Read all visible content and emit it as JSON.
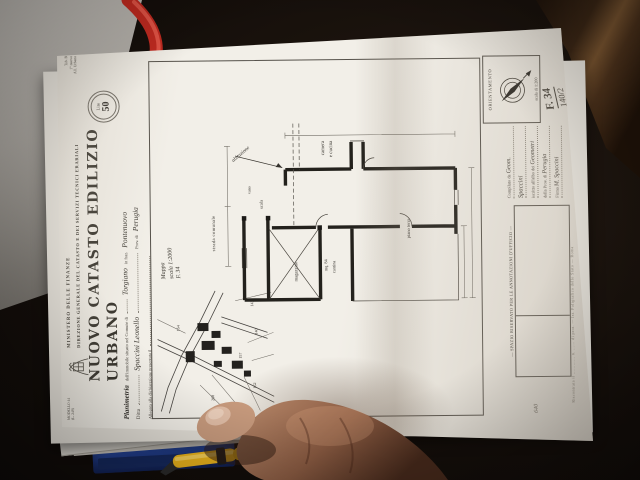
{
  "colors": {
    "paper": "#f2efe8",
    "folder_blue": "#2b51b0",
    "pen_yellow": "#e8b117",
    "tool_red": "#bf2a20",
    "ink": "#2e2b26"
  },
  "document": {
    "corner_top_left": [
      "MODELLO 44",
      "(L. 249)"
    ],
    "corner_top_right": [
      "Tab. B",
      "1° nuovo",
      "All. Urbano"
    ],
    "stamp": {
      "currency": "Lire",
      "value": "50"
    },
    "ministry": [
      "MINISTERO DELLE FINANZE",
      "DIREZIONE GENERALE DEL CATASTO E DEI SERVIZI TECNICI ERARIALI"
    ],
    "title": "NUOVO CATASTO EDILIZIO URBANO",
    "fields": {
      "f1_label": "Planimetria",
      "f1_pre": "dell'immobile situato nel Comune di",
      "f1_value": "Torgiano",
      "f1_mid": "in fraz.",
      "f1_value2": "Pontenuovo",
      "f2_label": "Ditta",
      "f2_value": "Spaccini Leonello",
      "f2_prov": "Prov. di",
      "f2_prov_value": "Perugia",
      "f3_label": "Allegata alla dichiarazione presentata il"
    },
    "map_note": [
      "Mappa",
      "scala 1:2000",
      "F. 34"
    ],
    "site_map": {
      "parcels": [
        "143",
        "140",
        "157",
        "162",
        "268",
        "154"
      ]
    },
    "floor_plan": {
      "labels": {
        "annotation": "abitazione",
        "room1": "camera",
        "room2": "e cucina",
        "stair": "scala",
        "vano": "vano",
        "store": "magazzino",
        "area": "mq. 84",
        "cellar": "cantina",
        "street": "strada comunale",
        "level": "piano terra"
      }
    },
    "orientation": {
      "label": "ORIENTAMENTO",
      "scale": "scala di 1:200"
    },
    "compilato": {
      "l1": "Compilato da",
      "v1": "Geom.",
      "v2": "Spaccini",
      "l2": "iscritto all'albo dei",
      "v3": "Geometri",
      "l3": "della Prov. di",
      "v4": "Perugia",
      "l4": "Firma",
      "v5": "M. Spaccini"
    },
    "annotations_header": "— SPAZIO RISERVATO PER LE ANNOTAZIONI D'UFFICIO —",
    "folio": {
      "line1": "F. 34",
      "line2": "140/2"
    },
    "side_note": "640",
    "bottom_line": "Riscontrata il ………… n. …… di prot. — Ist. Poligrafico dello Stato — Roma"
  }
}
